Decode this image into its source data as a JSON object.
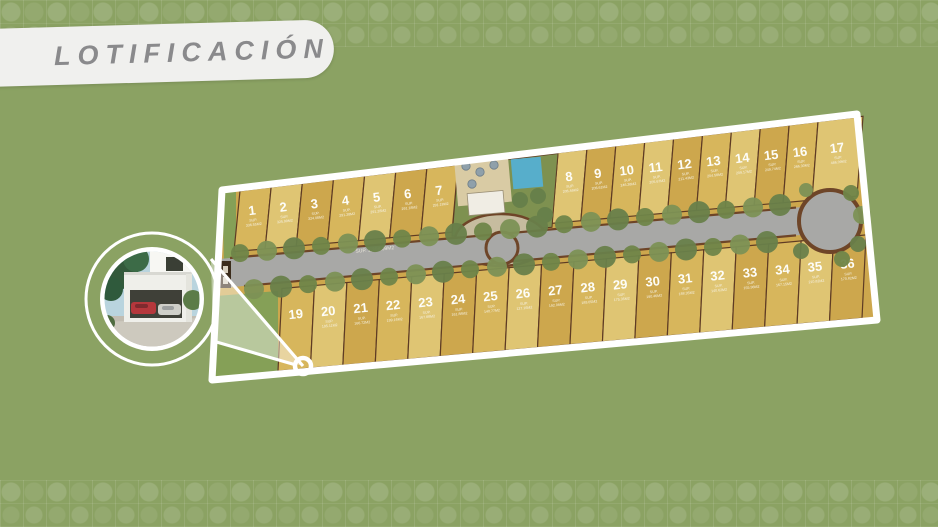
{
  "page": {
    "title_banner": "LOTIFICACIÓN"
  },
  "colors": {
    "background": "#8BA263",
    "banner_bg": "#F0F0EE",
    "banner_text": "#8A8A8C",
    "boundary_white": "#FFFFFF",
    "lot_gold_a": "#CDA74D",
    "lot_gold_b": "#D7B65C",
    "lot_gold_c": "#DFC573",
    "lot_stroke": "#5E3B24",
    "road_gray": "#A8A8A6",
    "road_edge_brown": "#6E4528",
    "lawn_green": "#7E9150",
    "pool_blue": "#57AECB",
    "patio_beige": "#D9CBA4",
    "tree_green": "#6F8549"
  },
  "plan": {
    "boundary_points": "222,190 857,114 877,320 212,380",
    "lines": {
      "top_edge": [
        222,
        190,
        857,
        114
      ],
      "road_top": [
        230,
        258,
        802,
        207
      ],
      "road_bottom": [
        244,
        286,
        800,
        235
      ],
      "bottom_edge": [
        212,
        380,
        876,
        320
      ]
    },
    "top_groups": [
      {
        "x0": 234,
        "x1": 452,
        "start": 1,
        "count": 7
      },
      {
        "x0": 552,
        "x1": 812,
        "start": 8,
        "count": 9
      },
      {
        "x0": 812,
        "x1": 857,
        "start": 17,
        "count": 1
      }
    ],
    "bottom_row": {
      "x0": 278,
      "x1": 862,
      "start": 19,
      "count": 18
    },
    "sup_prefix": "SUP.",
    "road_label": "SUP. 1,398.09M2",
    "roundabout": {
      "cx": 830,
      "cy": 221,
      "r": 31
    },
    "mid_circle": {
      "cx": 502,
      "cy": 248,
      "r": 16
    },
    "amenity_x": [
      452,
      552
    ],
    "lots": [
      {
        "n": 1,
        "sup": "336.55M2"
      },
      {
        "n": 2,
        "sup": "325.99M2"
      },
      {
        "n": 3,
        "sup": "324.08M2"
      },
      {
        "n": 4,
        "sup": "291.28M2"
      },
      {
        "n": 5,
        "sup": "291.28M2"
      },
      {
        "n": 6,
        "sup": "291.18M2"
      },
      {
        "n": 7,
        "sup": "291.18M2"
      },
      {
        "n": 8,
        "sup": "206.46M2"
      },
      {
        "n": 9,
        "sup": "206.61M2"
      },
      {
        "n": 10,
        "sup": "246.38M2"
      },
      {
        "n": 11,
        "sup": "205.67M2"
      },
      {
        "n": 12,
        "sup": "211.43M2"
      },
      {
        "n": 13,
        "sup": "204.58M2"
      },
      {
        "n": 14,
        "sup": "209.17M2"
      },
      {
        "n": 15,
        "sup": "249.74M2"
      },
      {
        "n": 16,
        "sup": "266.30M2"
      },
      {
        "n": 17,
        "sup": "486.09M2"
      },
      {
        "n": 19,
        "sup": ""
      },
      {
        "n": 20,
        "sup": "195.11M2"
      },
      {
        "n": 21,
        "sup": "166.72M2"
      },
      {
        "n": 22,
        "sup": "199.16M2"
      },
      {
        "n": 23,
        "sup": "167.88M2"
      },
      {
        "n": 24,
        "sup": "161.88M2"
      },
      {
        "n": 25,
        "sup": "140.77M2"
      },
      {
        "n": 26,
        "sup": "127.16M2"
      },
      {
        "n": 27,
        "sup": "192.08M2"
      },
      {
        "n": 28,
        "sup": "189.05M2"
      },
      {
        "n": 29,
        "sup": "175.35M2"
      },
      {
        "n": 30,
        "sup": "190.46M2"
      },
      {
        "n": 31,
        "sup": "188.35M2"
      },
      {
        "n": 32,
        "sup": "140.62M2"
      },
      {
        "n": 33,
        "sup": "155.98M2"
      },
      {
        "n": 34,
        "sup": "167.15M2"
      },
      {
        "n": 35,
        "sup": "210.82M2"
      },
      {
        "n": 36,
        "sup": "170.82M2"
      }
    ]
  },
  "inset": {
    "outer_circle": {
      "cx": 152,
      "cy": 299,
      "r": 66
    },
    "photo_circle": {
      "cx": 152,
      "cy": 299,
      "r": 52
    },
    "marker": {
      "cx": 303,
      "cy": 366,
      "r": 8
    }
  }
}
